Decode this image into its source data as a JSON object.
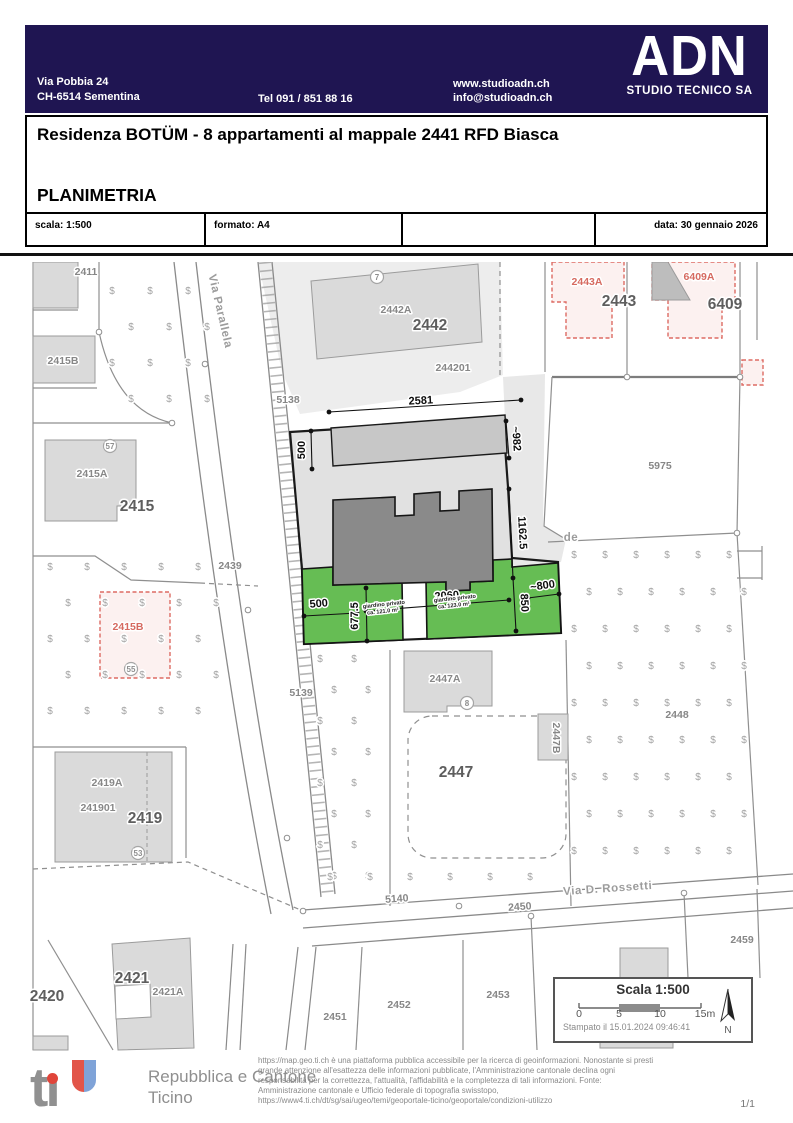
{
  "header": {
    "address_line1": "Via Pobbia 24",
    "address_line2": "CH-6514 Sementina",
    "phone": "Tel 091 / 851 88 16",
    "website": "www.studioadn.ch",
    "email": "info@studioadn.ch",
    "logo_text": "ADN",
    "company": "STUDIO TECNICO SA",
    "brand_color": "#1f1552"
  },
  "title_block": {
    "project_title": "Residenza BOTÜM - 8 appartamenti al mappale 2441 RFD Biasca",
    "drawing_title": "PLANIMETRIA",
    "scala": "scala: 1:500",
    "formato": "formato: A4",
    "data": "data: 30 gennaio 2026"
  },
  "map": {
    "colors": {
      "garden_green": "#66bd54",
      "building_dark": "#8a8a8a",
      "planned_red": "#dd6b63"
    },
    "labels": [
      {
        "t": "2411",
        "x": 86,
        "y": 275,
        "c": "lbl"
      },
      {
        "t": "2415B",
        "x": 63,
        "y": 364,
        "c": "lbl"
      },
      {
        "t": "2415A",
        "x": 92,
        "y": 477,
        "c": "lbl"
      },
      {
        "t": "2415",
        "x": 137,
        "y": 511,
        "c": "big"
      },
      {
        "t": "2439",
        "x": 230,
        "y": 569,
        "c": "lbl"
      },
      {
        "t": "2415B",
        "x": 128,
        "y": 630,
        "c": "red"
      },
      {
        "t": "5138",
        "x": 288,
        "y": 403,
        "c": "lbl"
      },
      {
        "t": "Via Parallela",
        "x": 217,
        "y": 312,
        "c": "street",
        "r": 77
      },
      {
        "t": "2442A",
        "x": 396,
        "y": 313,
        "c": "lbl"
      },
      {
        "t": "2442",
        "x": 430,
        "y": 330,
        "c": "big"
      },
      {
        "t": "244201",
        "x": 453,
        "y": 371,
        "c": "lbl"
      },
      {
        "t": "2443A",
        "x": 587,
        "y": 285,
        "c": "red"
      },
      {
        "t": "2443",
        "x": 619,
        "y": 306,
        "c": "big"
      },
      {
        "t": "6409A",
        "x": 699,
        "y": 280,
        "c": "red"
      },
      {
        "t": "6409",
        "x": 725,
        "y": 309,
        "c": "big"
      },
      {
        "t": "5975",
        "x": 660,
        "y": 469,
        "c": "lbl"
      },
      {
        "t": "de",
        "x": 571,
        "y": 541,
        "c": "street"
      },
      {
        "t": "5139",
        "x": 301,
        "y": 696,
        "c": "lbl"
      },
      {
        "t": "2447A",
        "x": 445,
        "y": 682,
        "c": "lbl"
      },
      {
        "t": "2447B",
        "x": 553,
        "y": 738,
        "c": "lbl",
        "r": 90
      },
      {
        "t": "2447",
        "x": 456,
        "y": 777,
        "c": "big"
      },
      {
        "t": "2448",
        "x": 677,
        "y": 718,
        "c": "lbl"
      },
      {
        "t": "5140",
        "x": 397,
        "y": 902,
        "c": "lbl",
        "r": -4
      },
      {
        "t": "2450",
        "x": 520,
        "y": 910,
        "c": "lbl",
        "r": -4
      },
      {
        "t": "Via D. Rossetti",
        "x": 608,
        "y": 892,
        "c": "street",
        "r": -4
      },
      {
        "t": "2459",
        "x": 742,
        "y": 943,
        "c": "lbl"
      },
      {
        "t": "2419A",
        "x": 107,
        "y": 786,
        "c": "lbl"
      },
      {
        "t": "241901",
        "x": 98,
        "y": 811,
        "c": "lbl"
      },
      {
        "t": "2419",
        "x": 145,
        "y": 823,
        "c": "big"
      },
      {
        "t": "2421",
        "x": 132,
        "y": 983,
        "c": "big"
      },
      {
        "t": "2421A",
        "x": 168,
        "y": 995,
        "c": "lbl"
      },
      {
        "t": "2420",
        "x": 47,
        "y": 1001,
        "c": "big"
      },
      {
        "t": "2451",
        "x": 335,
        "y": 1020,
        "c": "lbl"
      },
      {
        "t": "2452",
        "x": 399,
        "y": 1008,
        "c": "lbl"
      },
      {
        "t": "2453",
        "x": 498,
        "y": 998,
        "c": "lbl"
      },
      {
        "t": "2581",
        "x": 421,
        "y": 404,
        "c": "dim",
        "r": -3
      },
      {
        "t": "500",
        "x": 305,
        "y": 450,
        "c": "dim",
        "r": -90
      },
      {
        "t": "~982",
        "x": 513,
        "y": 439,
        "c": "dim",
        "r": 86
      },
      {
        "t": "1162.5",
        "x": 519,
        "y": 533,
        "c": "dim",
        "r": 87
      },
      {
        "t": "500",
        "x": 319,
        "y": 607,
        "c": "dim",
        "r": -5
      },
      {
        "t": "677.5",
        "x": 358,
        "y": 616,
        "c": "dim",
        "r": -90
      },
      {
        "t": "2060",
        "x": 447,
        "y": 599,
        "c": "dim",
        "r": -4
      },
      {
        "t": "850",
        "x": 521,
        "y": 603,
        "c": "dim",
        "r": 87
      },
      {
        "t": "~800",
        "x": 543,
        "y": 589,
        "c": "dim",
        "r": -8
      },
      {
        "t": "giardino privato",
        "x": 384,
        "y": 606,
        "c": "tiny",
        "r": -6
      },
      {
        "t": "ca. 121.0 m²",
        "x": 383,
        "y": 613,
        "c": "tiny",
        "r": -6
      },
      {
        "t": "giardino privato",
        "x": 455,
        "y": 600,
        "c": "tiny",
        "r": -6
      },
      {
        "t": "ca. 123.0 m²",
        "x": 454,
        "y": 607,
        "c": "tiny",
        "r": -6
      }
    ],
    "circles": [
      {
        "t": "7",
        "x": 377,
        "y": 277
      },
      {
        "t": "57",
        "x": 110,
        "y": 446
      },
      {
        "t": "8",
        "x": 467,
        "y": 703
      },
      {
        "t": "53",
        "x": 138,
        "y": 853
      },
      {
        "t": "55",
        "x": 131,
        "y": 669
      }
    ],
    "veg": {
      "symbol": "$",
      "regions": [
        {
          "x": 112,
          "y": 294,
          "cols": 3,
          "rows": 4,
          "dx": 38,
          "dy": 36,
          "sx": 19
        },
        {
          "x": 50,
          "y": 570,
          "cols": 5,
          "rows": 5,
          "dx": 37,
          "dy": 36,
          "sx": 18
        },
        {
          "x": 320,
          "y": 662,
          "cols": 2,
          "rows": 8,
          "dx": 34,
          "dy": 31,
          "sx": 14
        },
        {
          "x": 574,
          "y": 558,
          "cols": 6,
          "rows": 9,
          "dx": 31,
          "dy": 37,
          "sx": 15
        },
        {
          "x": 330,
          "y": 880,
          "cols": 6,
          "rows": 1,
          "dx": 40,
          "dy": 0,
          "sx": 0
        }
      ]
    },
    "scale_box": {
      "title": "Scala 1:500",
      "ticks": [
        "0",
        "5",
        "10",
        "15m"
      ],
      "printed": "Stampato il 15.01.2024 09:46:41",
      "north": "N"
    }
  },
  "footer": {
    "logo_t": "t",
    "logo_i": "ı",
    "canton_line1": "Repubblica e Cantone",
    "canton_line2": "Ticino",
    "disclaimer_lines": [
      "https://map.geo.ti.ch è una piattaforma pubblica accessibile per la ricerca di geoinformazioni. Nonostante si presti",
      "grande attenzione all'esattezza delle informazioni pubblicate, l'Amministrazione cantonale declina ogni",
      "responsabilità per la correttezza, l'attualità, l'affidabilità e la completezza di tali informazioni. Fonte:",
      "Amministrazione cantonale e Ufficio federale di topografia swisstopo,",
      "https://www4.ti.ch/dt/sg/sai/ugeo/temi/geoportale-ticino/geoportale/condizioni-utilizzo"
    ],
    "page": "1/1"
  }
}
